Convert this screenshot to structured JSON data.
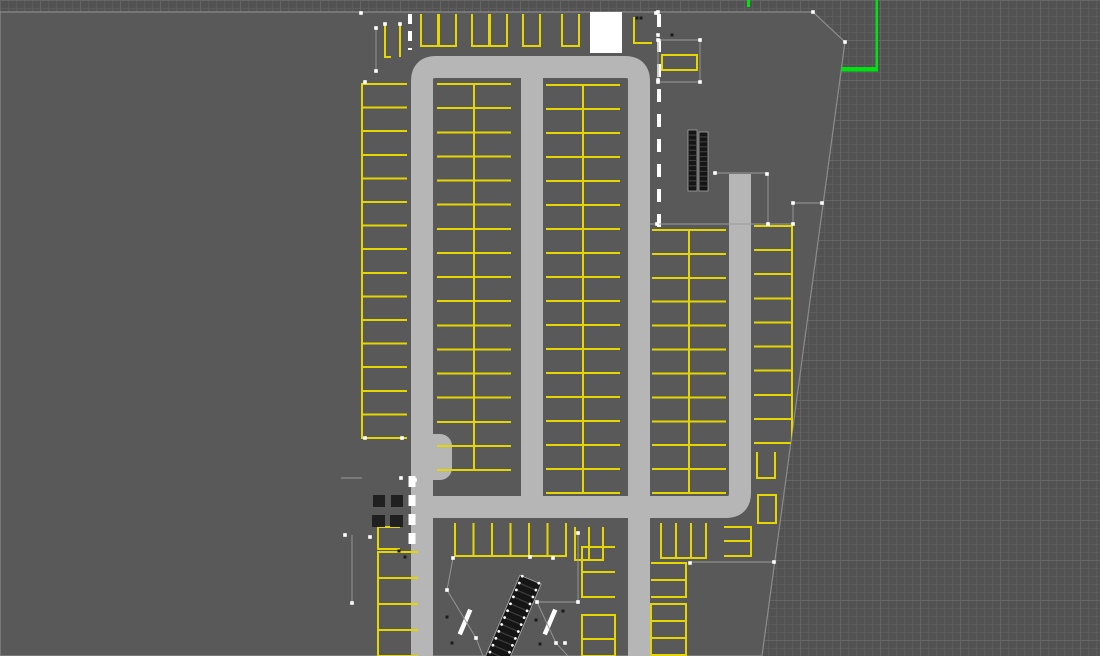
{
  "canvas": {
    "width": 1100,
    "height": 656
  },
  "colors": {
    "viewport_bg": "#525252",
    "grid_minor": "#5c5c5c",
    "grid_major": "#656565",
    "slab": "#59595a",
    "slab_edge": "#8c8c8c",
    "road": "#b6b6b6",
    "stall_line": "#e5d602",
    "white": "#ffffff",
    "axis_green": "#00e112",
    "stair_fill": "#151515",
    "stair_tread": "#3c3c3c",
    "stair_edge": "#a5a5a5",
    "pillar": "#202020",
    "construction": "#9a9a9a",
    "vertex": "#ffffff",
    "speck": "#1b1b1b"
  },
  "slab": {
    "polygon": [
      [
        0,
        12
      ],
      [
        813,
        12
      ],
      [
        845,
        42
      ],
      [
        762,
        656
      ],
      [
        0,
        656
      ]
    ]
  },
  "roads": {
    "paths": [
      {
        "d": "M 422,656 L 422,81 Q 422,67 436,67 L 625,67 Q 639,67 639,81 L 639,656",
        "w": 22
      },
      {
        "d": "M 532,78 L 532,506",
        "w": 22
      },
      {
        "d": "M 428,507 L 726,507 Q 740,507 740,493 L 740,174",
        "w": 22
      }
    ],
    "bulges": [
      [
        419,
        434,
        33,
        46,
        12
      ]
    ]
  },
  "elevator": [
    590,
    12,
    32,
    41
  ],
  "stalls": {
    "columns": [
      {
        "x": 362,
        "w": 45,
        "y0": 84,
        "y1": 438,
        "count": 15,
        "open": "right"
      },
      {
        "x": 437,
        "w": 37,
        "y0": 84,
        "y1": 470,
        "count": 16,
        "open": "left"
      },
      {
        "x": 474,
        "w": 37,
        "y0": 84,
        "y1": 470,
        "count": 16,
        "open": "right"
      },
      {
        "x": 546,
        "w": 37,
        "y0": 85,
        "y1": 493,
        "count": 17,
        "open": "left"
      },
      {
        "x": 583,
        "w": 37,
        "y0": 85,
        "y1": 493,
        "count": 17,
        "open": "right"
      },
      {
        "x": 652,
        "w": 37,
        "y0": 230,
        "y1": 493,
        "count": 11,
        "open": "left"
      },
      {
        "x": 689,
        "w": 37,
        "y0": 230,
        "y1": 493,
        "count": 11,
        "open": "right"
      },
      {
        "x": 754,
        "w": 38,
        "y0": 226,
        "y1": 443,
        "count": 9,
        "open": "left"
      },
      {
        "x": 582,
        "w": 33,
        "y0": 547,
        "y1": 597,
        "count": 2,
        "open": "right"
      },
      {
        "x": 651,
        "w": 35,
        "y0": 563,
        "y1": 597,
        "count": 2,
        "open": "left"
      },
      {
        "x": 378,
        "w": 40,
        "y0": 552,
        "y1": 656,
        "count": 4,
        "open": "right"
      }
    ],
    "rows": [
      {
        "y": 14,
        "h": 32,
        "w": 17,
        "open": "top",
        "xs": [
          421,
          439,
          472,
          490,
          523,
          562
        ]
      },
      {
        "y": 523,
        "h": 33,
        "w": 18.5,
        "open": "top",
        "xs": [
          455,
          473.5,
          492,
          510.5,
          529,
          547.5
        ]
      }
    ],
    "extras": [
      [
        662,
        55,
        35,
        15,
        "none"
      ],
      [
        575,
        527,
        14,
        33,
        "top"
      ],
      [
        589,
        527,
        14,
        33,
        "top"
      ],
      [
        661,
        523,
        15,
        35,
        "top"
      ],
      [
        676,
        523,
        15,
        35,
        "top"
      ],
      [
        691,
        523,
        15,
        35,
        "top"
      ],
      [
        724,
        527,
        27,
        14,
        "left"
      ],
      [
        724,
        541,
        27,
        15,
        "left"
      ],
      [
        582,
        615,
        33,
        24,
        "none"
      ],
      [
        582,
        639,
        33,
        17,
        "none"
      ],
      [
        651,
        604,
        35,
        17,
        "none"
      ],
      [
        651,
        621,
        35,
        17,
        "none"
      ],
      [
        651,
        638,
        35,
        17,
        "none"
      ],
      [
        757,
        452,
        18,
        26,
        "top"
      ],
      [
        758,
        495,
        18,
        28,
        "none"
      ],
      [
        378,
        527,
        22,
        22,
        "right"
      ]
    ],
    "lines": [
      "M 634,17 L 634,43 L 652,43",
      "M 385,25 L 385,57 L 391,57",
      "M 400,25 L 400,57"
    ]
  },
  "stairs": [
    {
      "type": "twin-bars",
      "x": 688,
      "y": 130,
      "bar_w": 9,
      "bar_h": 61,
      "gap": 2,
      "steps": 12
    },
    {
      "type": "escalator",
      "cx": 510,
      "cy": 628,
      "len": 105,
      "wid": 23,
      "angle": 23,
      "steps": 14
    }
  ],
  "pillars": [
    [
      373,
      495,
      12,
      12
    ],
    [
      391,
      495,
      12,
      12
    ],
    [
      372,
      515,
      13,
      12
    ],
    [
      390,
      515,
      13,
      12
    ]
  ],
  "markings": {
    "dashed_lines": [
      {
        "x": 659,
        "y1": 14,
        "y2": 230,
        "w": 4,
        "dash": "13 12"
      },
      {
        "x": 412,
        "y1": 476,
        "y2": 544,
        "w": 7,
        "dash": "11 8"
      },
      {
        "x": 410,
        "y1": 14,
        "y2": 50,
        "w": 4,
        "dash": "10 7"
      }
    ],
    "handrails": [
      {
        "cx": 465,
        "cy": 622,
        "len": 27,
        "w": 4.5,
        "angle": 23
      },
      {
        "cx": 550,
        "cy": 622,
        "len": 27,
        "w": 4.5,
        "angle": 23
      }
    ],
    "construction_lines": [
      [
        658,
        40,
        700,
        40
      ],
      [
        700,
        40,
        700,
        82
      ],
      [
        658,
        40,
        658,
        82
      ],
      [
        658,
        82,
        700,
        82
      ],
      [
        715,
        173,
        768,
        173
      ],
      [
        768,
        173,
        768,
        224
      ],
      [
        650,
        224,
        795,
        224
      ],
      [
        793,
        203,
        822,
        203
      ],
      [
        793,
        203,
        793,
        224
      ],
      [
        376,
        28,
        376,
        71
      ],
      [
        341,
        478,
        362,
        478
      ],
      [
        352,
        535,
        352,
        604
      ],
      [
        578,
        531,
        578,
        602
      ],
      [
        537,
        602,
        578,
        602
      ],
      [
        453,
        558,
        447,
        590
      ],
      [
        447,
        590,
        476,
        638
      ],
      [
        476,
        638,
        483,
        656
      ],
      [
        537,
        602,
        556,
        643
      ],
      [
        556,
        643,
        568,
        656
      ],
      [
        690,
        562,
        774,
        562
      ]
    ],
    "specks": [
      [
        447,
        617
      ],
      [
        452,
        643
      ],
      [
        536,
        620
      ],
      [
        540,
        644
      ],
      [
        563,
        611
      ],
      [
        399,
        551
      ],
      [
        405,
        557
      ],
      [
        672,
        35
      ],
      [
        637,
        18
      ],
      [
        641,
        18
      ]
    ]
  },
  "axis": {
    "green_segments": [
      [
        875.5,
        0,
        2.5,
        70
      ],
      [
        841,
        67,
        37,
        4.5
      ],
      [
        747,
        0,
        3,
        7
      ]
    ]
  },
  "vertices": [
    [
      361,
      13
    ],
    [
      656,
      13
    ],
    [
      813,
      12
    ],
    [
      845,
      42
    ],
    [
      376,
      28
    ],
    [
      376,
      71
    ],
    [
      385,
      24
    ],
    [
      400,
      24
    ],
    [
      365,
      82
    ],
    [
      365,
      438
    ],
    [
      402,
      438
    ],
    [
      658,
      12
    ],
    [
      658,
      35
    ],
    [
      658,
      80
    ],
    [
      658,
      40
    ],
    [
      700,
      40
    ],
    [
      658,
      82
    ],
    [
      700,
      82
    ],
    [
      715,
      173
    ],
    [
      767,
      174
    ],
    [
      768,
      224
    ],
    [
      657,
      224
    ],
    [
      793,
      203
    ],
    [
      822,
      203
    ],
    [
      793,
      224
    ],
    [
      345,
      535
    ],
    [
      370,
      537
    ],
    [
      352,
      603
    ],
    [
      401,
      478
    ],
    [
      415,
      480
    ],
    [
      453,
      558
    ],
    [
      447,
      590
    ],
    [
      476,
      638
    ],
    [
      537,
      602
    ],
    [
      578,
      602
    ],
    [
      578,
      533
    ],
    [
      553,
      558
    ],
    [
      530,
      557
    ],
    [
      690,
      563
    ],
    [
      774,
      562
    ],
    [
      556,
      643
    ],
    [
      565,
      643
    ]
  ]
}
